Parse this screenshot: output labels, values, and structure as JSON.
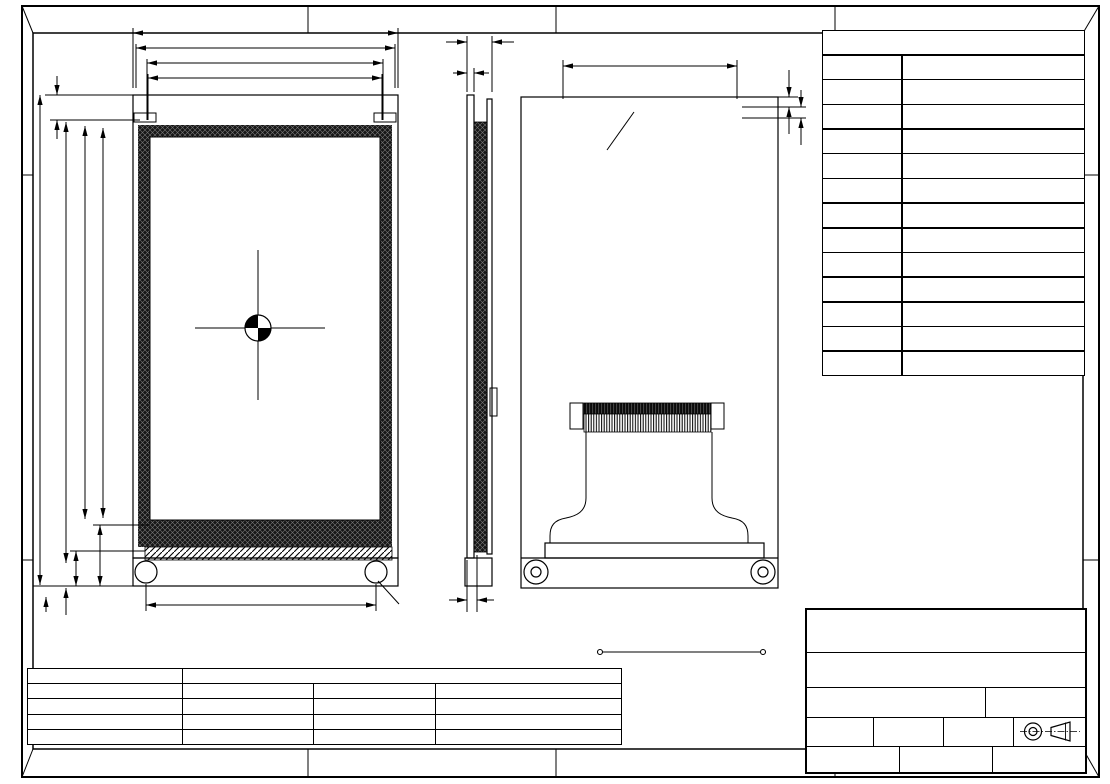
{
  "frame": {
    "zones_top": [
      "A",
      "B",
      "C",
      "D"
    ],
    "zones_bottom": [
      "A",
      "B",
      "C",
      "D"
    ],
    "zones_left": [
      "A",
      "D"
    ],
    "zones_right": [
      "A",
      "D"
    ]
  },
  "watermark": {
    "prefix": "由 ",
    "brand": "Autodesk",
    "suffix": " 教育版产品制作"
  },
  "front_view": {
    "center_lines": [
      "TFT 4.3″",
      "DOTS:480*3RGB*800",
      "Full View(80/80/80/80)"
    ],
    "dim_62": "62.25",
    "dim_60": "60.86",
    "dim_56v": "56.76(V.A)",
    "dim_56a": "56.16(A.A)",
    "dim_588_top": "5.88",
    "dim_117": "117.5",
    "dim_105": "105.75",
    "dim_94": "94.2(V.A)",
    "dim_93": "93.6(A.A)",
    "dim_1458": "14.58",
    "dim_84": "8.4",
    "dim_254": "2.54",
    "dim_588_bot": "5.88",
    "dim_5513": "55.13",
    "dim_hole": "Ø3",
    "pin_top_left": "2",
    "pin_top_right": "34",
    "pin_bot_left": "1",
    "pin_bot_right": "33"
  },
  "side_view": {
    "dim_max": "MAX6.0",
    "dim_16": "1.6",
    "dim_247": "2.47"
  },
  "back_view": {
    "dim_pitch": "P:2.54X(17-1)=40.64",
    "dim_hole": "Ø0.9",
    "dim_28": "2.8",
    "dim_254": "2.54",
    "pin_top_left": "34",
    "pin_top_right": "2",
    "pin_bot_left": "33",
    "pin_bot_right": "1"
  },
  "terminal_table": {
    "title": "Terminal",
    "col_no": "No.",
    "col_pin": "Pin Name",
    "rows": [
      [
        "1",
        "/CS"
      ],
      [
        "2",
        "RS"
      ],
      [
        "3",
        "/WR"
      ],
      [
        "4",
        "/RD"
      ],
      [
        "5",
        "/RST"
      ],
      [
        "6~21",
        "D0~D15"
      ],
      [
        "22",
        "VSS"
      ],
      [
        "23",
        "BL_EN(3~5V)"
      ],
      [
        "24~25",
        "VDD(3.3V)"
      ],
      [
        "26~27",
        "VSS"
      ],
      [
        "28",
        "BL_VDD(3~5V)"
      ],
      [
        "29~34",
        "NC"
      ]
    ]
  },
  "spec_table": {
    "rows": [
      [
        "*1. LCD Display Type",
        "TFT,Transmissive,Normally Black",
        "",
        ""
      ],
      [
        "*2. Viewing Diretion",
        "Full view",
        "*6. Storage Temp",
        "-30°C~80°C"
      ],
      [
        "*3. Interface",
        "with MCU 16bit",
        "*7. Driver IC",
        "NT35510"
      ],
      [
        "*4. Operating Voltage",
        "3.3V",
        "*8. Backlight",
        "WHITE VF=25.6V IF=20MA(TYP)"
      ],
      [
        "*5. Operating Temp",
        "-20°C~70°C",
        "*9. LCM Brightness",
        "500 cd/m² (Typ)"
      ]
    ]
  },
  "bl_circuit": {
    "label_a": "LED-A",
    "label_k": "LED-K",
    "title": "BL CIRCUIT DIAGRAM:",
    "value": "Vf=25.6V, If=20mA"
  },
  "title_block": {
    "company": "HOT DISPLAY",
    "dwg_label": "Dwg Title:",
    "dwg_title": "LCM-TFT043T1WVP16N34D-V01",
    "edc_label": "EDC No:",
    "ver_label": "Ver:",
    "ver": "A/0",
    "scale_label": "Scale",
    "scale": "1:1",
    "unit_label": "Unit",
    "unit": "mm",
    "tol_label": "Tol.",
    "tol": "±0.3",
    "drawn_label": "Drawn",
    "checked_label": "Checked",
    "date_label": "Date:",
    "date": "2019-6-10"
  }
}
